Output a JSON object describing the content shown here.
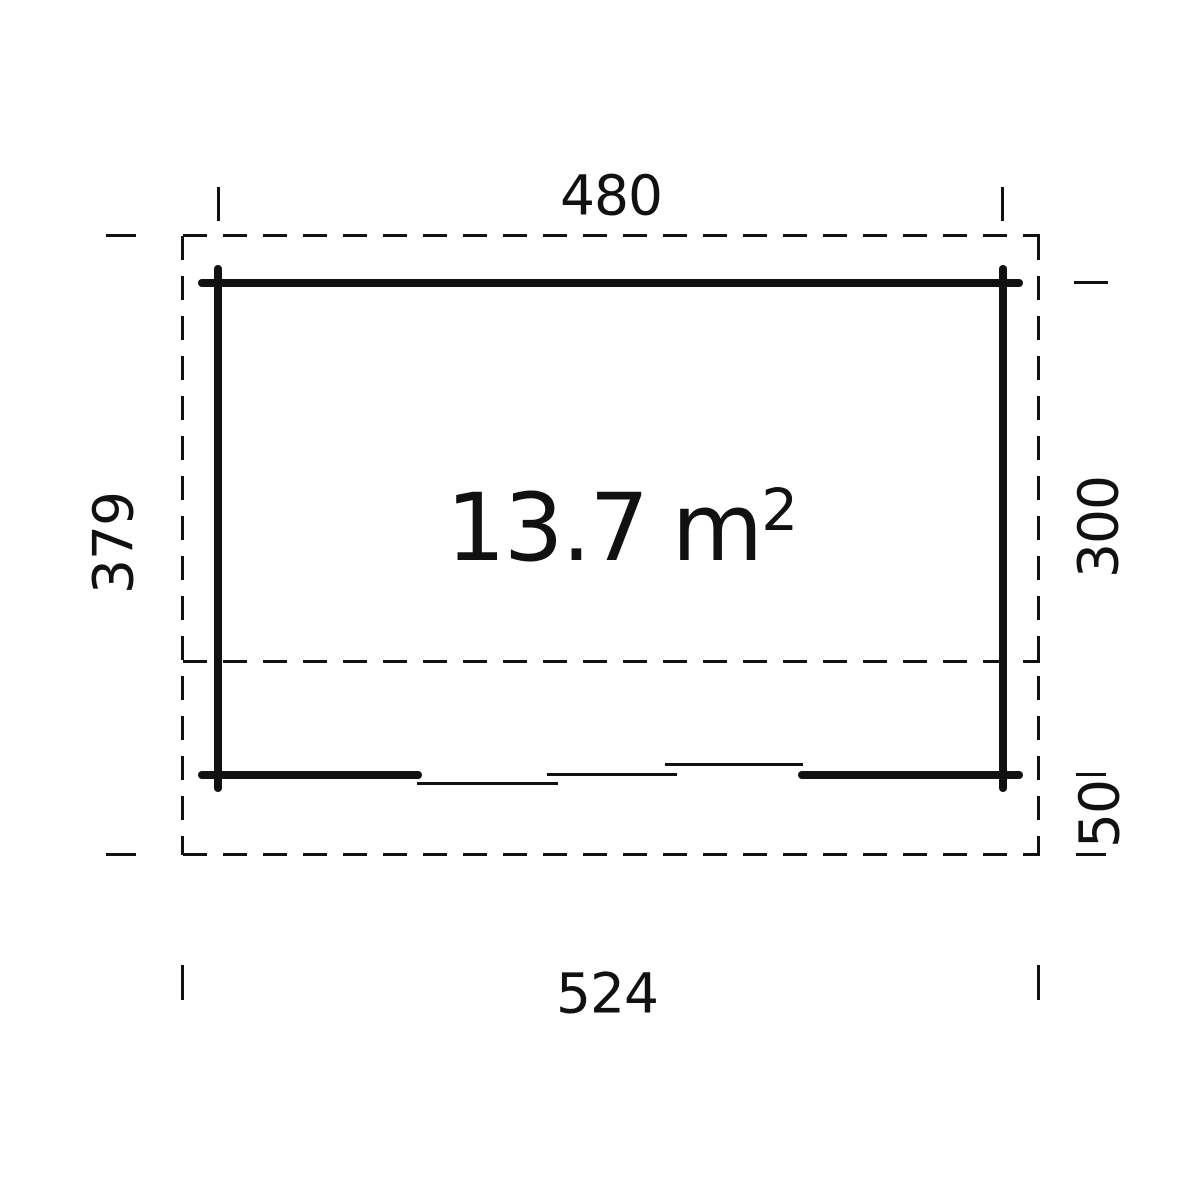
{
  "plan": {
    "area": {
      "value": "13.7",
      "unit_base": "m",
      "unit_exponent": "2"
    },
    "dimensions": {
      "top_wall_width": "480",
      "bottom_overall_width": "524",
      "left_overall_depth": "379",
      "right_inner_depth": "300",
      "right_front_overhang": "50"
    },
    "colors": {
      "line": "#111111",
      "background": "#ffffff"
    }
  }
}
